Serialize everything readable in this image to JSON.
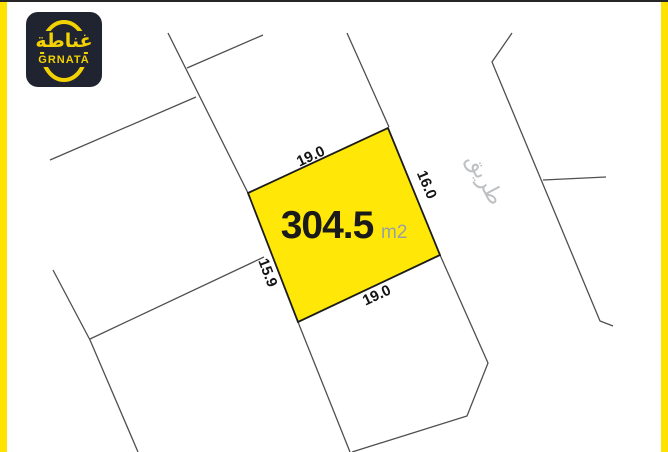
{
  "brand": {
    "logo_arabic": "غناطة",
    "logo_latin": "GRNATA",
    "logo_bg": "#1F2430",
    "logo_yellow": "#F3D203"
  },
  "frame": {
    "side_bar_color": "#FFE200",
    "top_line_color": "#262626"
  },
  "plot": {
    "area_value": "304.5",
    "area_unit": "m2",
    "fill_color": "#FFE808",
    "border_color": "#1C1C1C",
    "dimensions": {
      "top": "19.0",
      "right": "16.0",
      "bottom": "19.0",
      "left": "15.9"
    }
  },
  "road": {
    "label": "طريق",
    "label_color": "#BDC1C4"
  },
  "map": {
    "parcel_line_color": "#4F4F4F"
  }
}
